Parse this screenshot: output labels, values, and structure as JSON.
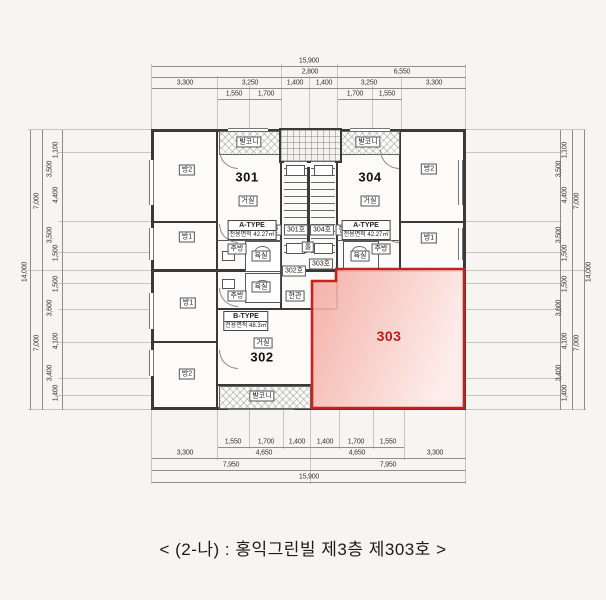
{
  "caption": "< (2-나) :  홍익그린빌 제3층 제303호 >",
  "highlight": {
    "unit": "303",
    "border_color": "#c3241e",
    "fill_from": "#f3a99f",
    "fill_to": "#fdeae7",
    "text_color": "#c01a12"
  },
  "units": {
    "u301": {
      "number": "301",
      "type": "A-TYPE",
      "area": "전용면적 42.27㎡"
    },
    "u304": {
      "number": "304",
      "type": "A-TYPE",
      "area": "전용면적 42.27㎡"
    },
    "u302": {
      "number": "302",
      "type": "B-TYPE",
      "area": "전용면적 48.3㎡"
    },
    "u303": {
      "number": "303"
    }
  },
  "labels": {
    "balcony": "발코니",
    "living": "거실",
    "room1": "방1",
    "room2": "방2",
    "kitchen": "주방",
    "bath": "욕실",
    "entrance": "현관",
    "hall": "홀",
    "door_301": "301호",
    "door_302": "302호",
    "door_303": "303호",
    "door_304": "304호"
  },
  "dimensions": {
    "top": {
      "total": "15,900",
      "row2": [
        "2,800",
        "6,550"
      ],
      "row3": [
        "3,300",
        "3,250",
        "1,400",
        "1,400",
        "3,250",
        "3,300"
      ],
      "row4": [
        "1,550",
        "1,700",
        "1,700",
        "1,550"
      ]
    },
    "bottom": {
      "row1": [
        "1,550",
        "1,700",
        "1,400",
        "1,400",
        "1,700",
        "1,550"
      ],
      "row2": [
        "3,300",
        "4,650",
        "4,650",
        "3,300"
      ],
      "row3": [
        "7,950",
        "7,950"
      ],
      "total": "15,900"
    },
    "left": {
      "inner": [
        "1,100",
        "3,500",
        "4,400",
        "3,500",
        "1,500",
        "1,500",
        "3,600",
        "4,100",
        "3,400",
        "1,400"
      ],
      "mid": [
        "7,000",
        "7,000"
      ],
      "total": "14,000"
    },
    "right": {
      "inner": [
        "1,100",
        "3,500",
        "4,400",
        "3,500",
        "1,500",
        "1,500",
        "3,600",
        "4,100",
        "3,400",
        "1,400"
      ],
      "mid": [
        "7,000",
        "7,000"
      ],
      "total": "14,000"
    }
  }
}
